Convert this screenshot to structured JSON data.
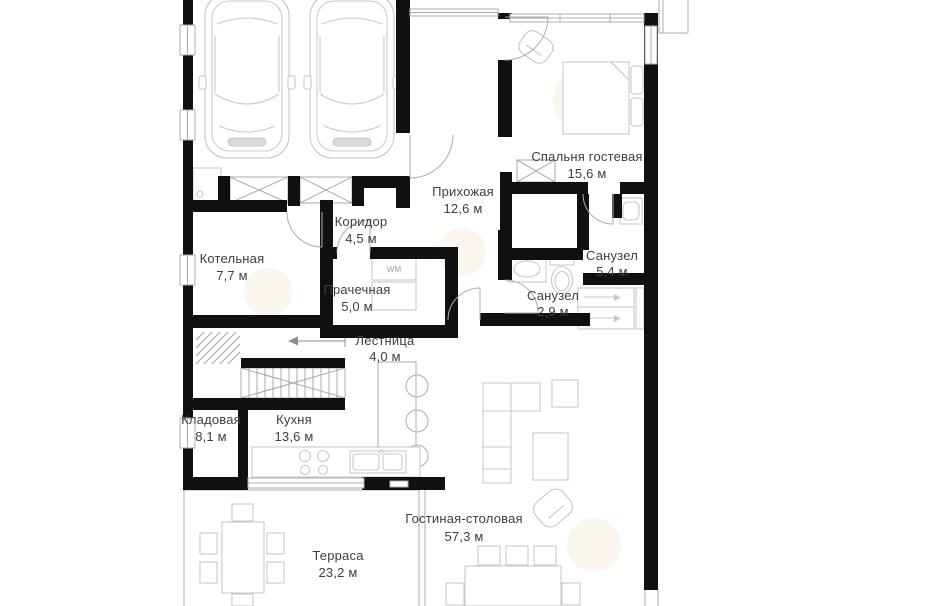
{
  "floorplan": {
    "rooms": [
      {
        "name": "Прихожая",
        "area": "12,6 м"
      },
      {
        "name": "Спальня гостевая",
        "area": "15,6 м"
      },
      {
        "name": "Коридор",
        "area": "4,5 м"
      },
      {
        "name": "Котельная",
        "area": "7,7 м"
      },
      {
        "name": "Прачечная",
        "area": "5,0 м"
      },
      {
        "name": "Санузел",
        "area": "5,4 м"
      },
      {
        "name": "Санузел",
        "area": "2,9 м"
      },
      {
        "name": "Лестница",
        "area": "4,0 м"
      },
      {
        "name": "Кладовая",
        "area": "8,1 м"
      },
      {
        "name": "Кухня",
        "area": "13,6 м"
      },
      {
        "name": "Гостиная-столовая",
        "area": "57,3 м"
      },
      {
        "name": "Терраса",
        "area": "23,2 м"
      }
    ],
    "appliances": {
      "washer_label": "WM"
    },
    "colors": {
      "wall": "#101010",
      "thin_line": "#a9aeb2",
      "furniture_line": "#c5c9cd",
      "label_text": "#3e3e3e"
    }
  }
}
